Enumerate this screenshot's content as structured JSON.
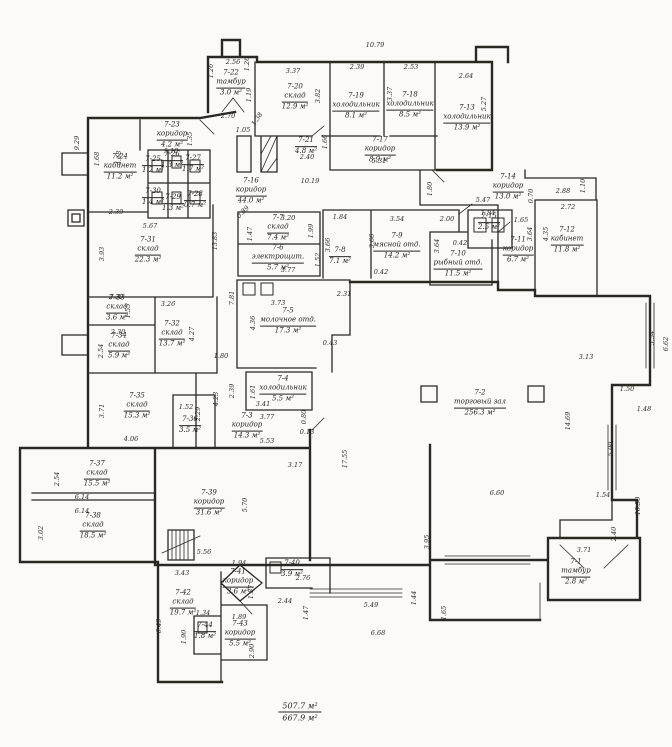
{
  "document": {
    "type": "floor-plan-scan",
    "language": "ru",
    "footer": {
      "net_area": "507.7 м²",
      "gross_area": "667.9 м²"
    }
  },
  "colors": {
    "ink": "#2b2823",
    "paper": "#fbfaf6"
  },
  "rooms": [
    {
      "id": "7-1",
      "name": "тамбур",
      "area": "2.8 м²",
      "x": 576,
      "y": 572
    },
    {
      "id": "7-2",
      "name": "торговый зал",
      "area": "256.3 м²",
      "x": 480,
      "y": 403
    },
    {
      "id": "7-3",
      "name": "коридор",
      "area": "14.3 м²",
      "x": 247,
      "y": 426
    },
    {
      "id": "7-4",
      "name": "холодильник",
      "area": "5.5 м²",
      "x": 283,
      "y": 389
    },
    {
      "id": "7-5",
      "name": "молочное отд.",
      "area": "17.3 м²",
      "x": 288,
      "y": 321
    },
    {
      "id": "7-6",
      "name": "электрощит.",
      "area": "5.7 м²",
      "x": 278,
      "y": 258
    },
    {
      "id": "7-7",
      "name": "склад",
      "area": "7.4 м²",
      "x": 278,
      "y": 228
    },
    {
      "id": "7-8",
      "name": "",
      "area": "7.1 м²",
      "x": 340,
      "y": 256
    },
    {
      "id": "7-9",
      "name": "мясной отд.",
      "area": "14.2 м²",
      "x": 397,
      "y": 246
    },
    {
      "id": "7-10",
      "name": "рыбный отд.",
      "area": "11.5 м²",
      "x": 458,
      "y": 264
    },
    {
      "id": "7-11",
      "name": "коридор",
      "area": "6.7 м²",
      "x": 518,
      "y": 250
    },
    {
      "id": "7-12",
      "name": "кабинет",
      "area": "11.8 м²",
      "x": 567,
      "y": 240
    },
    {
      "id": "7-13",
      "name": "холодильник",
      "area": "13.9 м²",
      "x": 467,
      "y": 118
    },
    {
      "id": "7-14",
      "name": "коридор",
      "area": "13.0 м²",
      "x": 508,
      "y": 187
    },
    {
      "id": "7-15",
      "name": "",
      "area": "2.5 м²",
      "x": 489,
      "y": 222
    },
    {
      "id": "7-16",
      "name": "коридор",
      "area": "44.0 м²",
      "x": 251,
      "y": 191
    },
    {
      "id": "7-17",
      "name": "коридор",
      "area": "8.9 м²",
      "x": 380,
      "y": 150
    },
    {
      "id": "7-18",
      "name": "холодильник",
      "area": "8.5 м²",
      "x": 410,
      "y": 105
    },
    {
      "id": "7-19",
      "name": "холодильник",
      "area": "8.1 м²",
      "x": 356,
      "y": 106
    },
    {
      "id": "7-20",
      "name": "склад",
      "area": "12.9 м²",
      "x": 295,
      "y": 97
    },
    {
      "id": "7-21",
      "name": "",
      "area": "4.8 м²",
      "x": 306,
      "y": 146
    },
    {
      "id": "7-22",
      "name": "тамбур",
      "area": "3.0 м²",
      "x": 231,
      "y": 83
    },
    {
      "id": "7-23",
      "name": "коридор",
      "area": "4.2 м²",
      "x": 172,
      "y": 135
    },
    {
      "id": "7-24",
      "name": "кабинет",
      "area": "11.2 м²",
      "x": 120,
      "y": 167
    },
    {
      "id": "7-25",
      "name": "",
      "area": "1.2 м²",
      "x": 153,
      "y": 165
    },
    {
      "id": "7-26",
      "name": "",
      "area": "1.3 м²",
      "x": 172,
      "y": 160
    },
    {
      "id": "7-27",
      "name": "",
      "area": "1.7 м²",
      "x": 193,
      "y": 164
    },
    {
      "id": "7-28",
      "name": "",
      "area": "0.7 м²",
      "x": 195,
      "y": 200
    },
    {
      "id": "7-29",
      "name": "",
      "area": "1.3 м²",
      "x": 173,
      "y": 203
    },
    {
      "id": "7-30",
      "name": "",
      "area": "1.4 м²",
      "x": 153,
      "y": 197
    },
    {
      "id": "7-31",
      "name": "склад",
      "area": "22.3 м²",
      "x": 148,
      "y": 250
    },
    {
      "id": "7-32",
      "name": "склад",
      "area": "13.7 м²",
      "x": 172,
      "y": 334
    },
    {
      "id": "7-33",
      "name": "склад",
      "area": "3.6 м²",
      "x": 117,
      "y": 308
    },
    {
      "id": "7-34",
      "name": "склад",
      "area": "5.9 м²",
      "x": 119,
      "y": 346
    },
    {
      "id": "7-35",
      "name": "склад",
      "area": "15.3 м²",
      "x": 137,
      "y": 406
    },
    {
      "id": "7-36",
      "name": "",
      "area": "3.5 м²",
      "x": 190,
      "y": 425
    },
    {
      "id": "7-37",
      "name": "склад",
      "area": "15.5 м²",
      "x": 97,
      "y": 474
    },
    {
      "id": "7-38",
      "name": "склад",
      "area": "18.5 м²",
      "x": 93,
      "y": 526
    },
    {
      "id": "7-39",
      "name": "коридор",
      "area": "31.6 м²",
      "x": 209,
      "y": 503
    },
    {
      "id": "7-40",
      "name": "",
      "area": "3.9 м²",
      "x": 292,
      "y": 569
    },
    {
      "id": "7-41",
      "name": "коридор",
      "area": "3.6 м²",
      "x": 238,
      "y": 582
    },
    {
      "id": "7-42",
      "name": "склад",
      "area": "19.7 м²",
      "x": 183,
      "y": 603
    },
    {
      "id": "7-43",
      "name": "коридор",
      "area": "5.5 м²",
      "x": 240,
      "y": 634
    },
    {
      "id": "7-44",
      "name": "",
      "area": "1.8 м²",
      "x": 205,
      "y": 631
    }
  ],
  "dims": [
    {
      "v": "10.79",
      "x": 375,
      "y": 45,
      "r": 0
    },
    {
      "v": "2.56",
      "x": 233,
      "y": 62,
      "r": 0
    },
    {
      "v": "1.26",
      "x": 211,
      "y": 71,
      "r": 90
    },
    {
      "v": "1.26",
      "x": 247,
      "y": 64,
      "r": 90
    },
    {
      "v": "3.37",
      "x": 293,
      "y": 71,
      "r": 0
    },
    {
      "v": "2.39",
      "x": 357,
      "y": 67,
      "r": 0
    },
    {
      "v": "2.53",
      "x": 411,
      "y": 67,
      "r": 0
    },
    {
      "v": "2.64",
      "x": 466,
      "y": 76,
      "r": 0
    },
    {
      "v": "3.82",
      "x": 318,
      "y": 96,
      "r": 90
    },
    {
      "v": "3.37",
      "x": 390,
      "y": 94,
      "r": 90
    },
    {
      "v": "5.27",
      "x": 484,
      "y": 104,
      "r": 90
    },
    {
      "v": "1.19",
      "x": 249,
      "y": 95,
      "r": 90
    },
    {
      "v": "2.70",
      "x": 228,
      "y": 116,
      "r": 0
    },
    {
      "v": "1.05",
      "x": 243,
      "y": 130,
      "r": 0
    },
    {
      "v": "1.38",
      "x": 257,
      "y": 119,
      "r": 55
    },
    {
      "v": "2.40",
      "x": 307,
      "y": 157,
      "r": 0
    },
    {
      "v": "1.66",
      "x": 325,
      "y": 142,
      "r": 90
    },
    {
      "v": "10.19",
      "x": 310,
      "y": 181,
      "r": 0
    },
    {
      "v": "5.31",
      "x": 379,
      "y": 161,
      "r": 0
    },
    {
      "v": "5.47",
      "x": 483,
      "y": 200,
      "r": 0
    },
    {
      "v": "2.88",
      "x": 563,
      "y": 191,
      "r": 0
    },
    {
      "v": "1.10",
      "x": 583,
      "y": 186,
      "r": 90
    },
    {
      "v": "2.72",
      "x": 568,
      "y": 207,
      "r": 0
    },
    {
      "v": "0.70",
      "x": 531,
      "y": 196,
      "r": 90
    },
    {
      "v": "1.65",
      "x": 521,
      "y": 220,
      "r": 0
    },
    {
      "v": "1.84",
      "x": 488,
      "y": 213,
      "r": 0
    },
    {
      "v": "2.00",
      "x": 447,
      "y": 219,
      "r": 0
    },
    {
      "v": "3.54",
      "x": 397,
      "y": 219,
      "r": 0
    },
    {
      "v": "1.84",
      "x": 340,
      "y": 217,
      "r": 0
    },
    {
      "v": "3.20",
      "x": 288,
      "y": 218,
      "r": 0
    },
    {
      "v": "0.89",
      "x": 243,
      "y": 212,
      "r": 45
    },
    {
      "v": "1.47",
      "x": 250,
      "y": 234,
      "r": 90
    },
    {
      "v": "1.99",
      "x": 311,
      "y": 231,
      "r": 90
    },
    {
      "v": "3.66",
      "x": 328,
      "y": 245,
      "r": 90
    },
    {
      "v": "3.66",
      "x": 372,
      "y": 241,
      "r": 90
    },
    {
      "v": "3.64",
      "x": 437,
      "y": 246,
      "r": 90
    },
    {
      "v": "4.35",
      "x": 546,
      "y": 234,
      "r": 90
    },
    {
      "v": "3.64",
      "x": 530,
      "y": 234,
      "r": 90
    },
    {
      "v": "0.42",
      "x": 460,
      "y": 243,
      "r": 0
    },
    {
      "v": "9.29",
      "x": 77,
      "y": 143,
      "r": 90
    },
    {
      "v": "1.68",
      "x": 97,
      "y": 159,
      "r": 90
    },
    {
      "v": "4.68",
      "x": 119,
      "y": 158,
      "r": 90
    },
    {
      "v": "5.10",
      "x": 171,
      "y": 151,
      "r": 0
    },
    {
      "v": "1.35",
      "x": 190,
      "y": 139,
      "r": 90
    },
    {
      "v": "2.39",
      "x": 116,
      "y": 212,
      "r": 0
    },
    {
      "v": "5.67",
      "x": 150,
      "y": 226,
      "r": 0
    },
    {
      "v": "3.93",
      "x": 102,
      "y": 254,
      "r": 90
    },
    {
      "v": "13.83",
      "x": 215,
      "y": 241,
      "r": 90
    },
    {
      "v": "1.80",
      "x": 430,
      "y": 189,
      "r": 90
    },
    {
      "v": "2.31",
      "x": 344,
      "y": 294,
      "r": 0
    },
    {
      "v": "3.73",
      "x": 278,
      "y": 303,
      "r": 0
    },
    {
      "v": "0.42",
      "x": 381,
      "y": 272,
      "r": 0
    },
    {
      "v": "0.43",
      "x": 330,
      "y": 343,
      "r": 0
    },
    {
      "v": "4.36",
      "x": 253,
      "y": 323,
      "r": 90
    },
    {
      "v": "1.52",
      "x": 318,
      "y": 260,
      "r": 90
    },
    {
      "v": "3.77",
      "x": 288,
      "y": 270,
      "r": 0
    },
    {
      "v": "3.26",
      "x": 168,
      "y": 304,
      "r": 0
    },
    {
      "v": "1.55",
      "x": 128,
      "y": 311,
      "r": 90
    },
    {
      "v": "2.30",
      "x": 116,
      "y": 297,
      "r": 0
    },
    {
      "v": "2.30",
      "x": 118,
      "y": 332,
      "r": 0
    },
    {
      "v": "2.54",
      "x": 101,
      "y": 351,
      "r": 90
    },
    {
      "v": "4.27",
      "x": 192,
      "y": 334,
      "r": 90
    },
    {
      "v": "7.81",
      "x": 232,
      "y": 298,
      "r": 90
    },
    {
      "v": "1.80",
      "x": 221,
      "y": 356,
      "r": 0
    },
    {
      "v": "2.39",
      "x": 232,
      "y": 391,
      "r": 90
    },
    {
      "v": "1.61",
      "x": 253,
      "y": 392,
      "r": 90
    },
    {
      "v": "3.41",
      "x": 263,
      "y": 404,
      "r": 0
    },
    {
      "v": "3.77",
      "x": 267,
      "y": 417,
      "r": 0
    },
    {
      "v": "0.80",
      "x": 304,
      "y": 417,
      "r": 90
    },
    {
      "v": "0.13",
      "x": 307,
      "y": 432,
      "r": 0
    },
    {
      "v": "5.53",
      "x": 267,
      "y": 441,
      "r": 0
    },
    {
      "v": "3.17",
      "x": 295,
      "y": 465,
      "r": 0
    },
    {
      "v": "4.23",
      "x": 216,
      "y": 399,
      "r": 90
    },
    {
      "v": "1.52",
      "x": 186,
      "y": 407,
      "r": 0
    },
    {
      "v": "2.29",
      "x": 198,
      "y": 414,
      "r": 90
    },
    {
      "v": "4.06",
      "x": 131,
      "y": 439,
      "r": 0
    },
    {
      "v": "3.71",
      "x": 102,
      "y": 411,
      "r": 90
    },
    {
      "v": "17.55",
      "x": 345,
      "y": 459,
      "r": 90
    },
    {
      "v": "14.69",
      "x": 568,
      "y": 421,
      "r": 90
    },
    {
      "v": "6.60",
      "x": 497,
      "y": 493,
      "r": 0
    },
    {
      "v": "3.13",
      "x": 586,
      "y": 357,
      "r": 0
    },
    {
      "v": "5.54",
      "x": 652,
      "y": 338,
      "r": 90
    },
    {
      "v": "6.62",
      "x": 666,
      "y": 344,
      "r": 90
    },
    {
      "v": "1.50",
      "x": 627,
      "y": 389,
      "r": 0
    },
    {
      "v": "1.48",
      "x": 644,
      "y": 409,
      "r": 0
    },
    {
      "v": "5.90",
      "x": 611,
      "y": 449,
      "r": 90
    },
    {
      "v": "1.54",
      "x": 603,
      "y": 495,
      "r": 0
    },
    {
      "v": "10.50",
      "x": 638,
      "y": 506,
      "r": 90
    },
    {
      "v": "2.40",
      "x": 614,
      "y": 534,
      "r": 90
    },
    {
      "v": "3.71",
      "x": 584,
      "y": 550,
      "r": 0
    },
    {
      "v": "3.95",
      "x": 427,
      "y": 542,
      "r": 90
    },
    {
      "v": "2.54",
      "x": 57,
      "y": 479,
      "r": 90
    },
    {
      "v": "6.14",
      "x": 82,
      "y": 497,
      "r": 0
    },
    {
      "v": "6.14",
      "x": 82,
      "y": 511,
      "r": 0
    },
    {
      "v": "3.02",
      "x": 41,
      "y": 533,
      "r": 90
    },
    {
      "v": "5.70",
      "x": 245,
      "y": 505,
      "r": 90
    },
    {
      "v": "5.56",
      "x": 204,
      "y": 552,
      "r": 0
    },
    {
      "v": "3.43",
      "x": 182,
      "y": 573,
      "r": 0
    },
    {
      "v": "1.94",
      "x": 239,
      "y": 563,
      "r": 0
    },
    {
      "v": "2.76",
      "x": 303,
      "y": 578,
      "r": 0
    },
    {
      "v": "1.87",
      "x": 251,
      "y": 592,
      "r": 90
    },
    {
      "v": "1.89",
      "x": 239,
      "y": 617,
      "r": 0
    },
    {
      "v": "1.34",
      "x": 203,
      "y": 613,
      "r": 0
    },
    {
      "v": "1.90",
      "x": 184,
      "y": 637,
      "r": 90
    },
    {
      "v": "2.90",
      "x": 252,
      "y": 651,
      "r": 90
    },
    {
      "v": "6.49",
      "x": 159,
      "y": 626,
      "r": 90
    },
    {
      "v": "2.44",
      "x": 285,
      "y": 601,
      "r": 0
    },
    {
      "v": "1.47",
      "x": 306,
      "y": 613,
      "r": 90
    },
    {
      "v": "5.49",
      "x": 371,
      "y": 605,
      "r": 0
    },
    {
      "v": "6.68",
      "x": 378,
      "y": 633,
      "r": 0
    },
    {
      "v": "1.44",
      "x": 414,
      "y": 598,
      "r": 90
    },
    {
      "v": "1.65",
      "x": 444,
      "y": 613,
      "r": 90
    }
  ]
}
